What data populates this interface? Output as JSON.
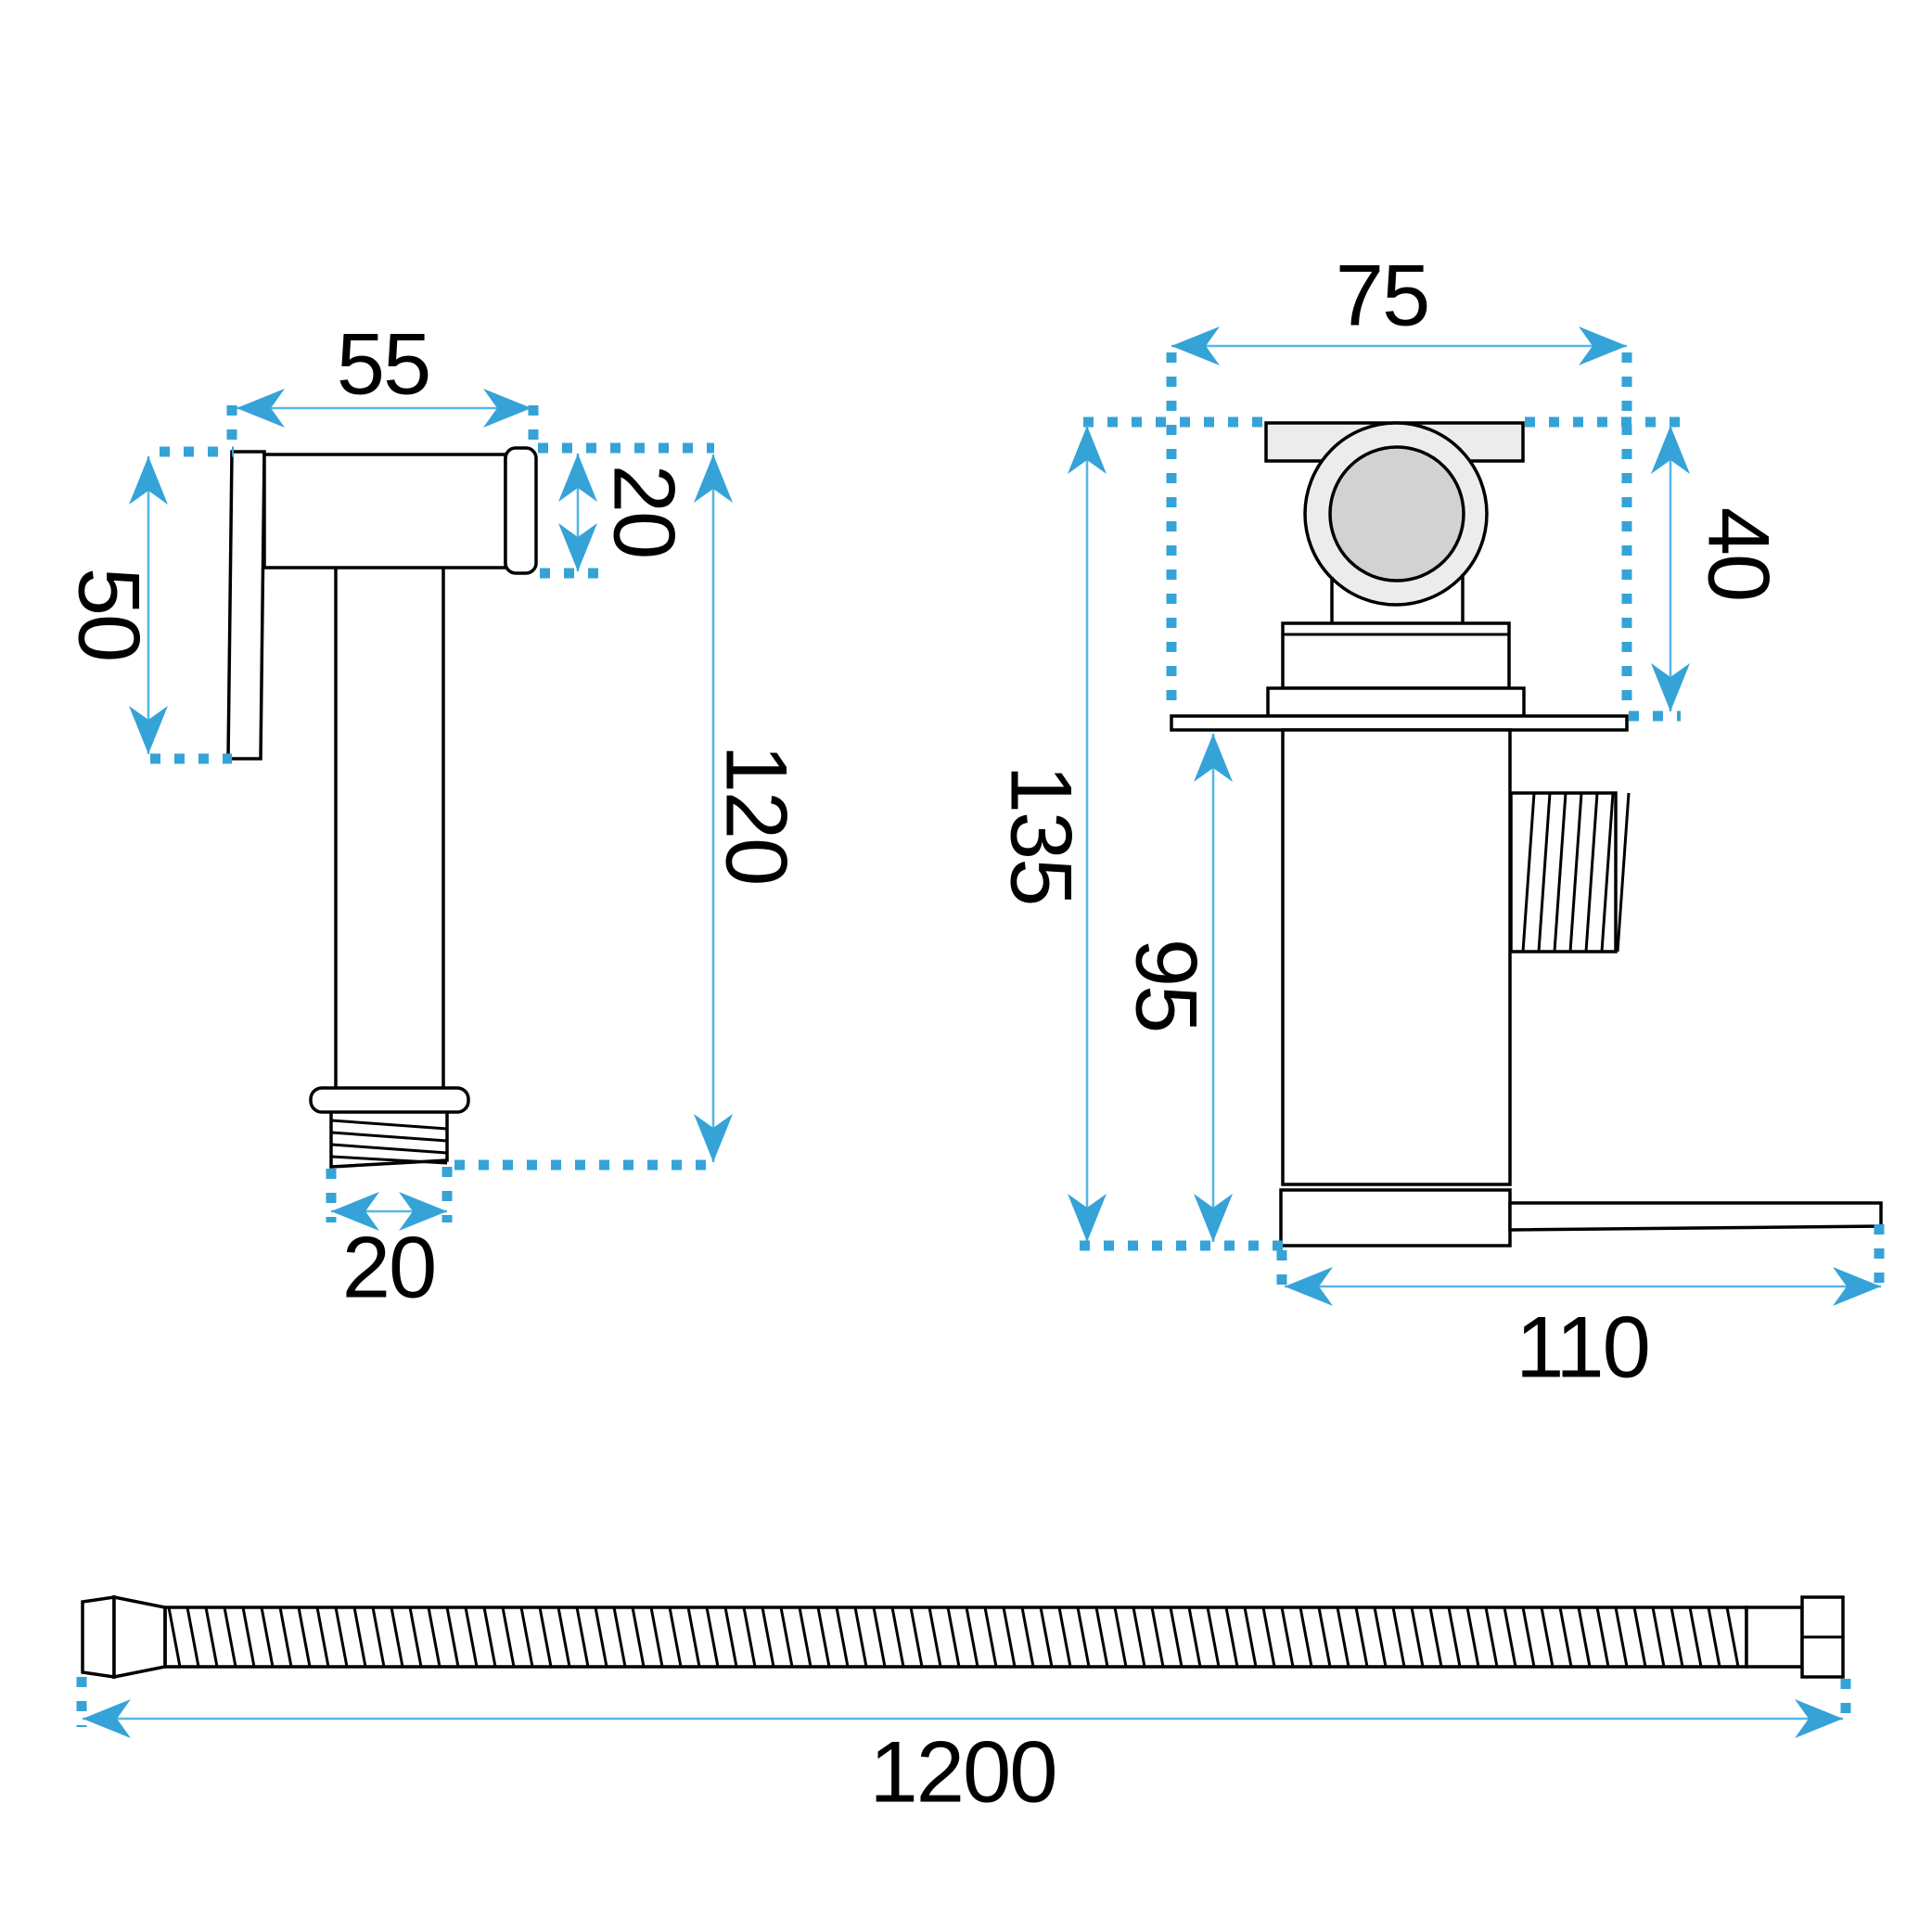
{
  "views": {
    "sprayer_side": {
      "dimensions": {
        "head_length": "55",
        "grip_height": "50",
        "head_diameter": "20",
        "body_length": "120",
        "connector_diameter": "20"
      }
    },
    "valve_front": {
      "dimensions": {
        "flange_width": "75",
        "handle_height": "40",
        "total_height": "135",
        "body_height": "95",
        "base_width": "110"
      }
    },
    "hose": {
      "dimensions": {
        "length": "1200"
      }
    }
  },
  "colors": {
    "dimension_arrow_blue": "#35A3D7",
    "dimension_line_blue": "#58B7E5",
    "outline_black": "#000000",
    "fill_light_gray": "#ECECEC",
    "fill_mid_gray": "#D2D2D2",
    "background": "#FFFFFF"
  }
}
